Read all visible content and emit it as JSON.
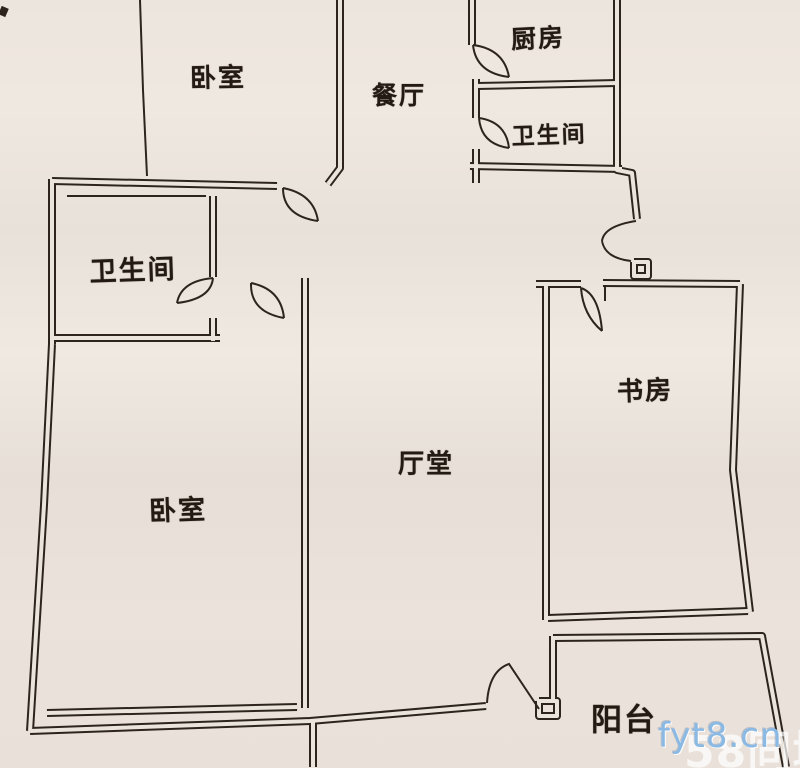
{
  "plan": {
    "width": 800,
    "height": 768,
    "colors": {
      "line": "#2c241d",
      "paper": "#ebe4dc",
      "watermark_blue": "#8ab9e4",
      "watermark_white": "#ffffff"
    },
    "style": {
      "wall_outer": 8,
      "wall_inner": 4,
      "thin": 2
    },
    "walls": [
      [
        [
          52,
          181
        ],
        [
          277,
          186
        ]
      ],
      [
        [
          340,
          0
        ],
        [
          340,
          168
        ],
        [
          328,
          184
        ]
      ],
      [
        [
          52,
          179
        ],
        [
          52,
          344
        ]
      ],
      [
        [
          52,
          344
        ],
        [
          44,
          505
        ],
        [
          34,
          666
        ],
        [
          30,
          731
        ]
      ],
      [
        [
          30,
          731
        ],
        [
          310,
          721
        ],
        [
          486,
          706
        ]
      ],
      [
        [
          47,
          713
        ],
        [
          297,
          707
        ]
      ],
      [
        [
          305,
          278
        ],
        [
          305,
          708
        ]
      ],
      [
        [
          213,
          196
        ],
        [
          213,
          277
        ]
      ],
      [
        [
          213,
          318
        ],
        [
          213,
          341
        ]
      ],
      [
        [
          52,
          338
        ],
        [
          220,
          338
        ]
      ],
      [
        [
          472,
          0
        ],
        [
          472,
          45
        ]
      ],
      [
        [
          477,
          86
        ],
        [
          617,
          83
        ]
      ],
      [
        [
          476,
          79
        ],
        [
          476,
          118
        ]
      ],
      [
        [
          476,
          149
        ],
        [
          476,
          183
        ]
      ],
      [
        [
          470,
          166
        ],
        [
          622,
          169
        ]
      ],
      [
        [
          617,
          0
        ],
        [
          617,
          170
        ],
        [
          632,
          173
        ],
        [
          637,
          219
        ]
      ],
      [
        [
          536,
          284
        ],
        [
          581,
          284
        ]
      ],
      [
        [
          603,
          283
        ],
        [
          740,
          284
        ]
      ],
      [
        [
          740,
          284
        ],
        [
          733,
          470
        ],
        [
          750,
          612
        ]
      ],
      [
        [
          546,
          284
        ],
        [
          546,
          620
        ]
      ],
      [
        [
          553,
          636
        ],
        [
          553,
          702
        ]
      ],
      [
        [
          548,
          618
        ],
        [
          748,
          611
        ]
      ],
      [
        [
          553,
          638
        ],
        [
          762,
          636
        ],
        [
          786,
          767
        ]
      ],
      [
        [
          313,
          722
        ],
        [
          313,
          767
        ]
      ],
      [
        [
          539,
          701
        ],
        [
          557,
          701
        ],
        [
          557,
          716
        ],
        [
          539,
          716
        ],
        [
          539,
          701
        ]
      ],
      [
        [
          634,
          262
        ],
        [
          648,
          262
        ],
        [
          648,
          276
        ],
        [
          634,
          276
        ],
        [
          634,
          262
        ]
      ]
    ],
    "thin_lines": [
      [
        [
          140,
          0
        ],
        [
          143,
          90
        ],
        [
          147,
          176
        ]
      ],
      [
        [
          67,
          196
        ],
        [
          206,
          196
        ]
      ],
      [
        [
          605,
          287
        ],
        [
          605,
          301
        ]
      ]
    ],
    "doors": [
      "M283,188 Q283,216 318,221 M283,188 Q314,194 318,221",
      "M213,278 Q181,281 177,303 M213,278 Q211,299 177,303",
      "M251,283 Q250,312 284,318 M251,283 Q281,289 284,318",
      "M473,45 Q476,73 509,77 M473,45 Q504,49 509,77",
      "M479,118 Q481,144 509,148 M479,118 Q506,122 509,148",
      "M636,221 Q604,226 602,241 M602,241 Q605,258 631,261",
      "M581,288 Q599,294 602,331 M581,288 Q583,315 602,331",
      "M487,703 Q489,671 509,664 L539,709"
    ],
    "marks": [
      [
        [
          0,
          10
        ],
        [
          7,
          13
        ]
      ]
    ]
  },
  "rooms": [
    {
      "id": "bedroom-top",
      "label": "卧室",
      "x": 218,
      "y": 76,
      "size": 26,
      "rot": -1
    },
    {
      "id": "dining",
      "label": "餐厅",
      "x": 399,
      "y": 94,
      "size": 25,
      "rot": 0
    },
    {
      "id": "kitchen",
      "label": "厨房",
      "x": 538,
      "y": 37,
      "size": 25,
      "rot": -3
    },
    {
      "id": "bathroom-top",
      "label": "卫生间",
      "x": 549,
      "y": 133,
      "size": 23,
      "rot": -2
    },
    {
      "id": "bathroom-left",
      "label": "卫生间",
      "x": 133,
      "y": 268,
      "size": 27,
      "rot": -2
    },
    {
      "id": "study",
      "label": "书房",
      "x": 645,
      "y": 389,
      "size": 26,
      "rot": -2
    },
    {
      "id": "hall",
      "label": "厅堂",
      "x": 426,
      "y": 462,
      "size": 26,
      "rot": 0
    },
    {
      "id": "bedroom-bottom",
      "label": "卧室",
      "x": 178,
      "y": 508,
      "size": 27,
      "rot": -2
    },
    {
      "id": "balcony",
      "label": "阳台",
      "x": 624,
      "y": 717,
      "size": 31,
      "rot": 0
    }
  ],
  "watermark": {
    "site_text": "fyt8.cn",
    "brand_text": "58同城"
  }
}
